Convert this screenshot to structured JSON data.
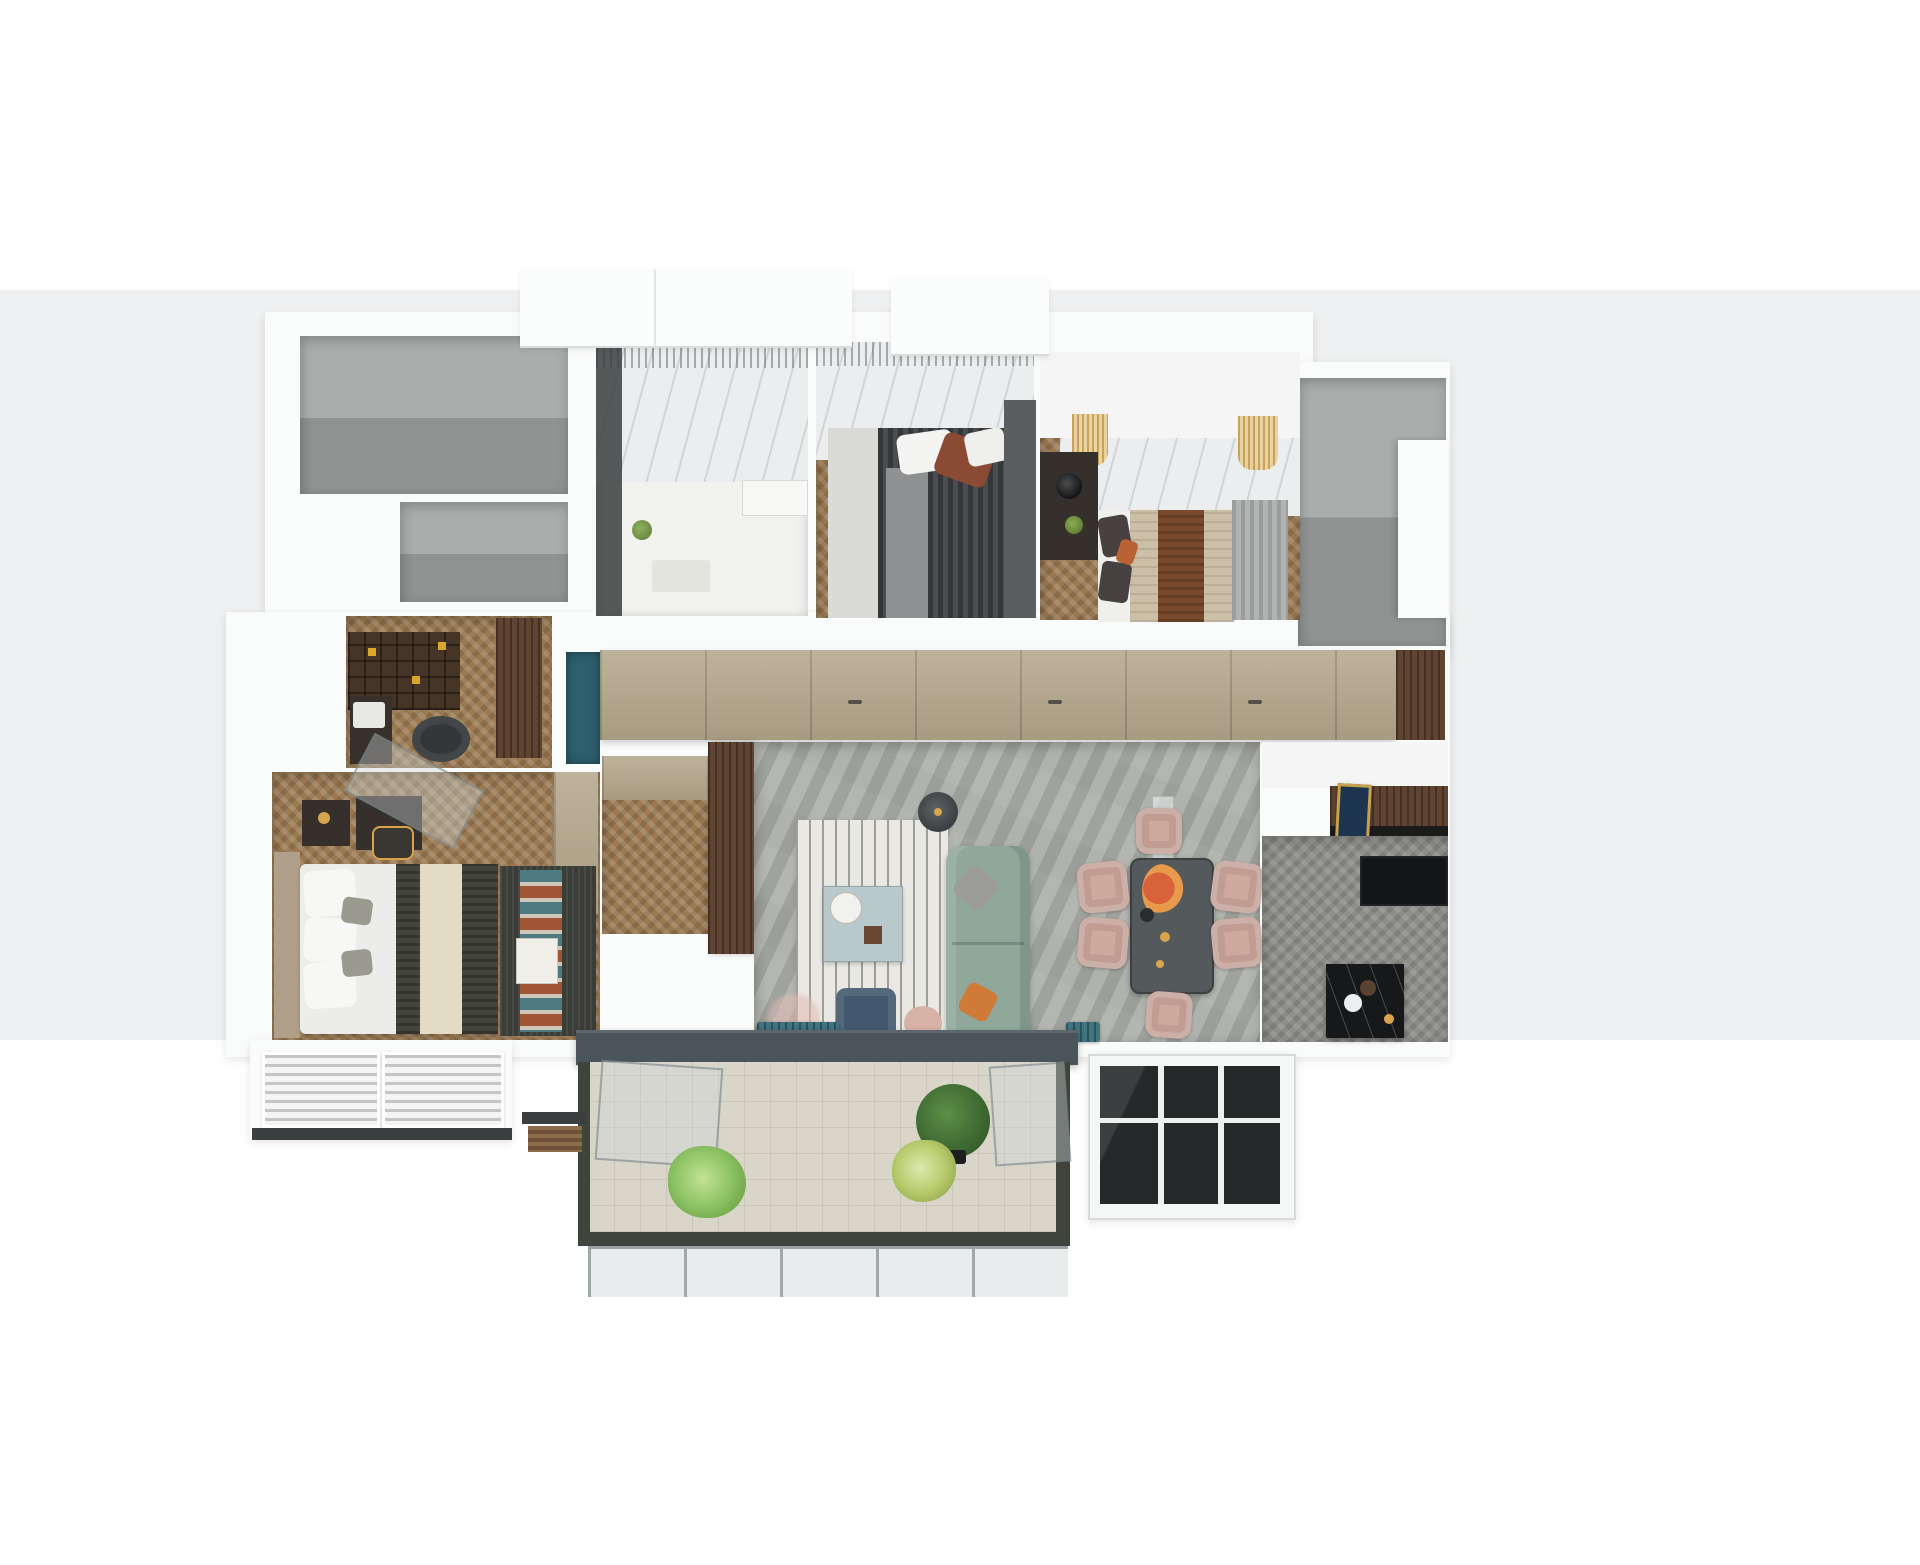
{
  "scene": {
    "type": "3d-floor-plan-render",
    "description": "Top-down 3D architectural render of a three-bedroom apartment with living-dining area, kitchen, two bathrooms-gray service shafts, study nook, walk-in closet and a large tiled balcony with plants",
    "text_content": [],
    "rooms": [
      {
        "id": "gray-shell-room-a",
        "label": "unfinished shell room (top left)"
      },
      {
        "id": "gray-shell-room-c",
        "label": "unfinished shell room (left, above study)"
      },
      {
        "id": "bathroom",
        "label": "bathroom with marble wall and shower"
      },
      {
        "id": "bedroom-1",
        "label": "bedroom with dark striped bed"
      },
      {
        "id": "bedroom-2",
        "label": "bedroom with beige bed and side lamp"
      },
      {
        "id": "gray-shell-room-b",
        "label": "unfinished shell / stair shaft (right)"
      },
      {
        "id": "hallway-wardrobe",
        "label": "hallway with long tan wardrobe"
      },
      {
        "id": "study-nook",
        "label": "study with bookshelf, desk and office chair"
      },
      {
        "id": "walk-in-closet",
        "label": "walk-in closet"
      },
      {
        "id": "master-bedroom",
        "label": "master bedroom with striped duvet and zigzag rug"
      },
      {
        "id": "living-room",
        "label": "living room with sage sofa, rug, coffee table"
      },
      {
        "id": "dining-area",
        "label": "dining table with six pink chairs and flowers"
      },
      {
        "id": "kitchen",
        "label": "kitchen with black island and walnut sideboard"
      },
      {
        "id": "balcony",
        "label": "tiled balcony with three plants"
      },
      {
        "id": "utility-balcony",
        "label": "utility balcony with dark glazing"
      }
    ],
    "furniture": [
      "double-bed-dark",
      "double-bed-beige",
      "master-bed",
      "sage-sofa",
      "coffee-table",
      "floor-lamp",
      "navy-armchair",
      "pink-ottoman",
      "teal-bench",
      "dining-table",
      "pink-dining-chairs",
      "glass-partition",
      "kitchen-island",
      "walnut-sideboard",
      "navy-wall-art",
      "bookshelf",
      "desk",
      "office-chair",
      "vanity-table",
      "balcony-plants",
      "louver-ac-units"
    ]
  },
  "colors": {
    "bg": "#ffffff",
    "band": "#eff0f1",
    "wall": "#fafbfb",
    "voidTop": "#a9adac",
    "voidBottom": "#8f9392",
    "marble": "#ecedee",
    "woodFloor": "#9b7a52",
    "stoneFloor": "#a9aca6",
    "tanWardrobe": "#b5a88c",
    "walnut": "#5f4431",
    "rugBase": "#eae8e2",
    "sofa": "#8fa89a",
    "pillowGray": "#9c9c98",
    "pillowOrange": "#cf7a36",
    "coffeeTable": "#b9c8cb",
    "armchairNavy": "#41586e",
    "ottomanPink": "#d8b2a6",
    "benchTeal": "#3f7480",
    "diningTable": "#54595c",
    "chairPink": "#cfa89e",
    "flowerOrange": "#d8633a",
    "gold": "#d8a44c",
    "kitchenFloor": "#8e8e8a",
    "counterBlack": "#141516",
    "islandBlack": "#17181a",
    "paintingNavy": "#1e3550",
    "sill": "#49545b",
    "balconyTile": "#d9d5c8",
    "balconyRim": "#3f443c",
    "plantDark": "#3f6b33",
    "plantLight": "#8fc06a",
    "plantYellow": "#b5c96a",
    "pot": "#1d1f1e",
    "bedDark": "#3c3e40",
    "bedCream": "#e4dbc4",
    "bedOlive": "#45463b",
    "rugMaster": "#3b3d39",
    "zigTeal": "#4e7a82",
    "zigRust": "#a05537",
    "beigeBlanket": "#cbbfa8",
    "brownRunner": "#7a4a2c",
    "bookshelf": "#463527",
    "accentYellow": "#d8a72c",
    "deskDark": "#38302a",
    "chairDark": "#34373a",
    "curtainGray": "#a3a5a5",
    "tealEntry": "#2d5f6e",
    "headboardTan": "#b0a089",
    "nightstand": "#35302c",
    "shower": "#3a3e40",
    "bathFloor": "#f1f1ee",
    "darkGlass": "#26292a",
    "rail": "#3b3f3f"
  }
}
